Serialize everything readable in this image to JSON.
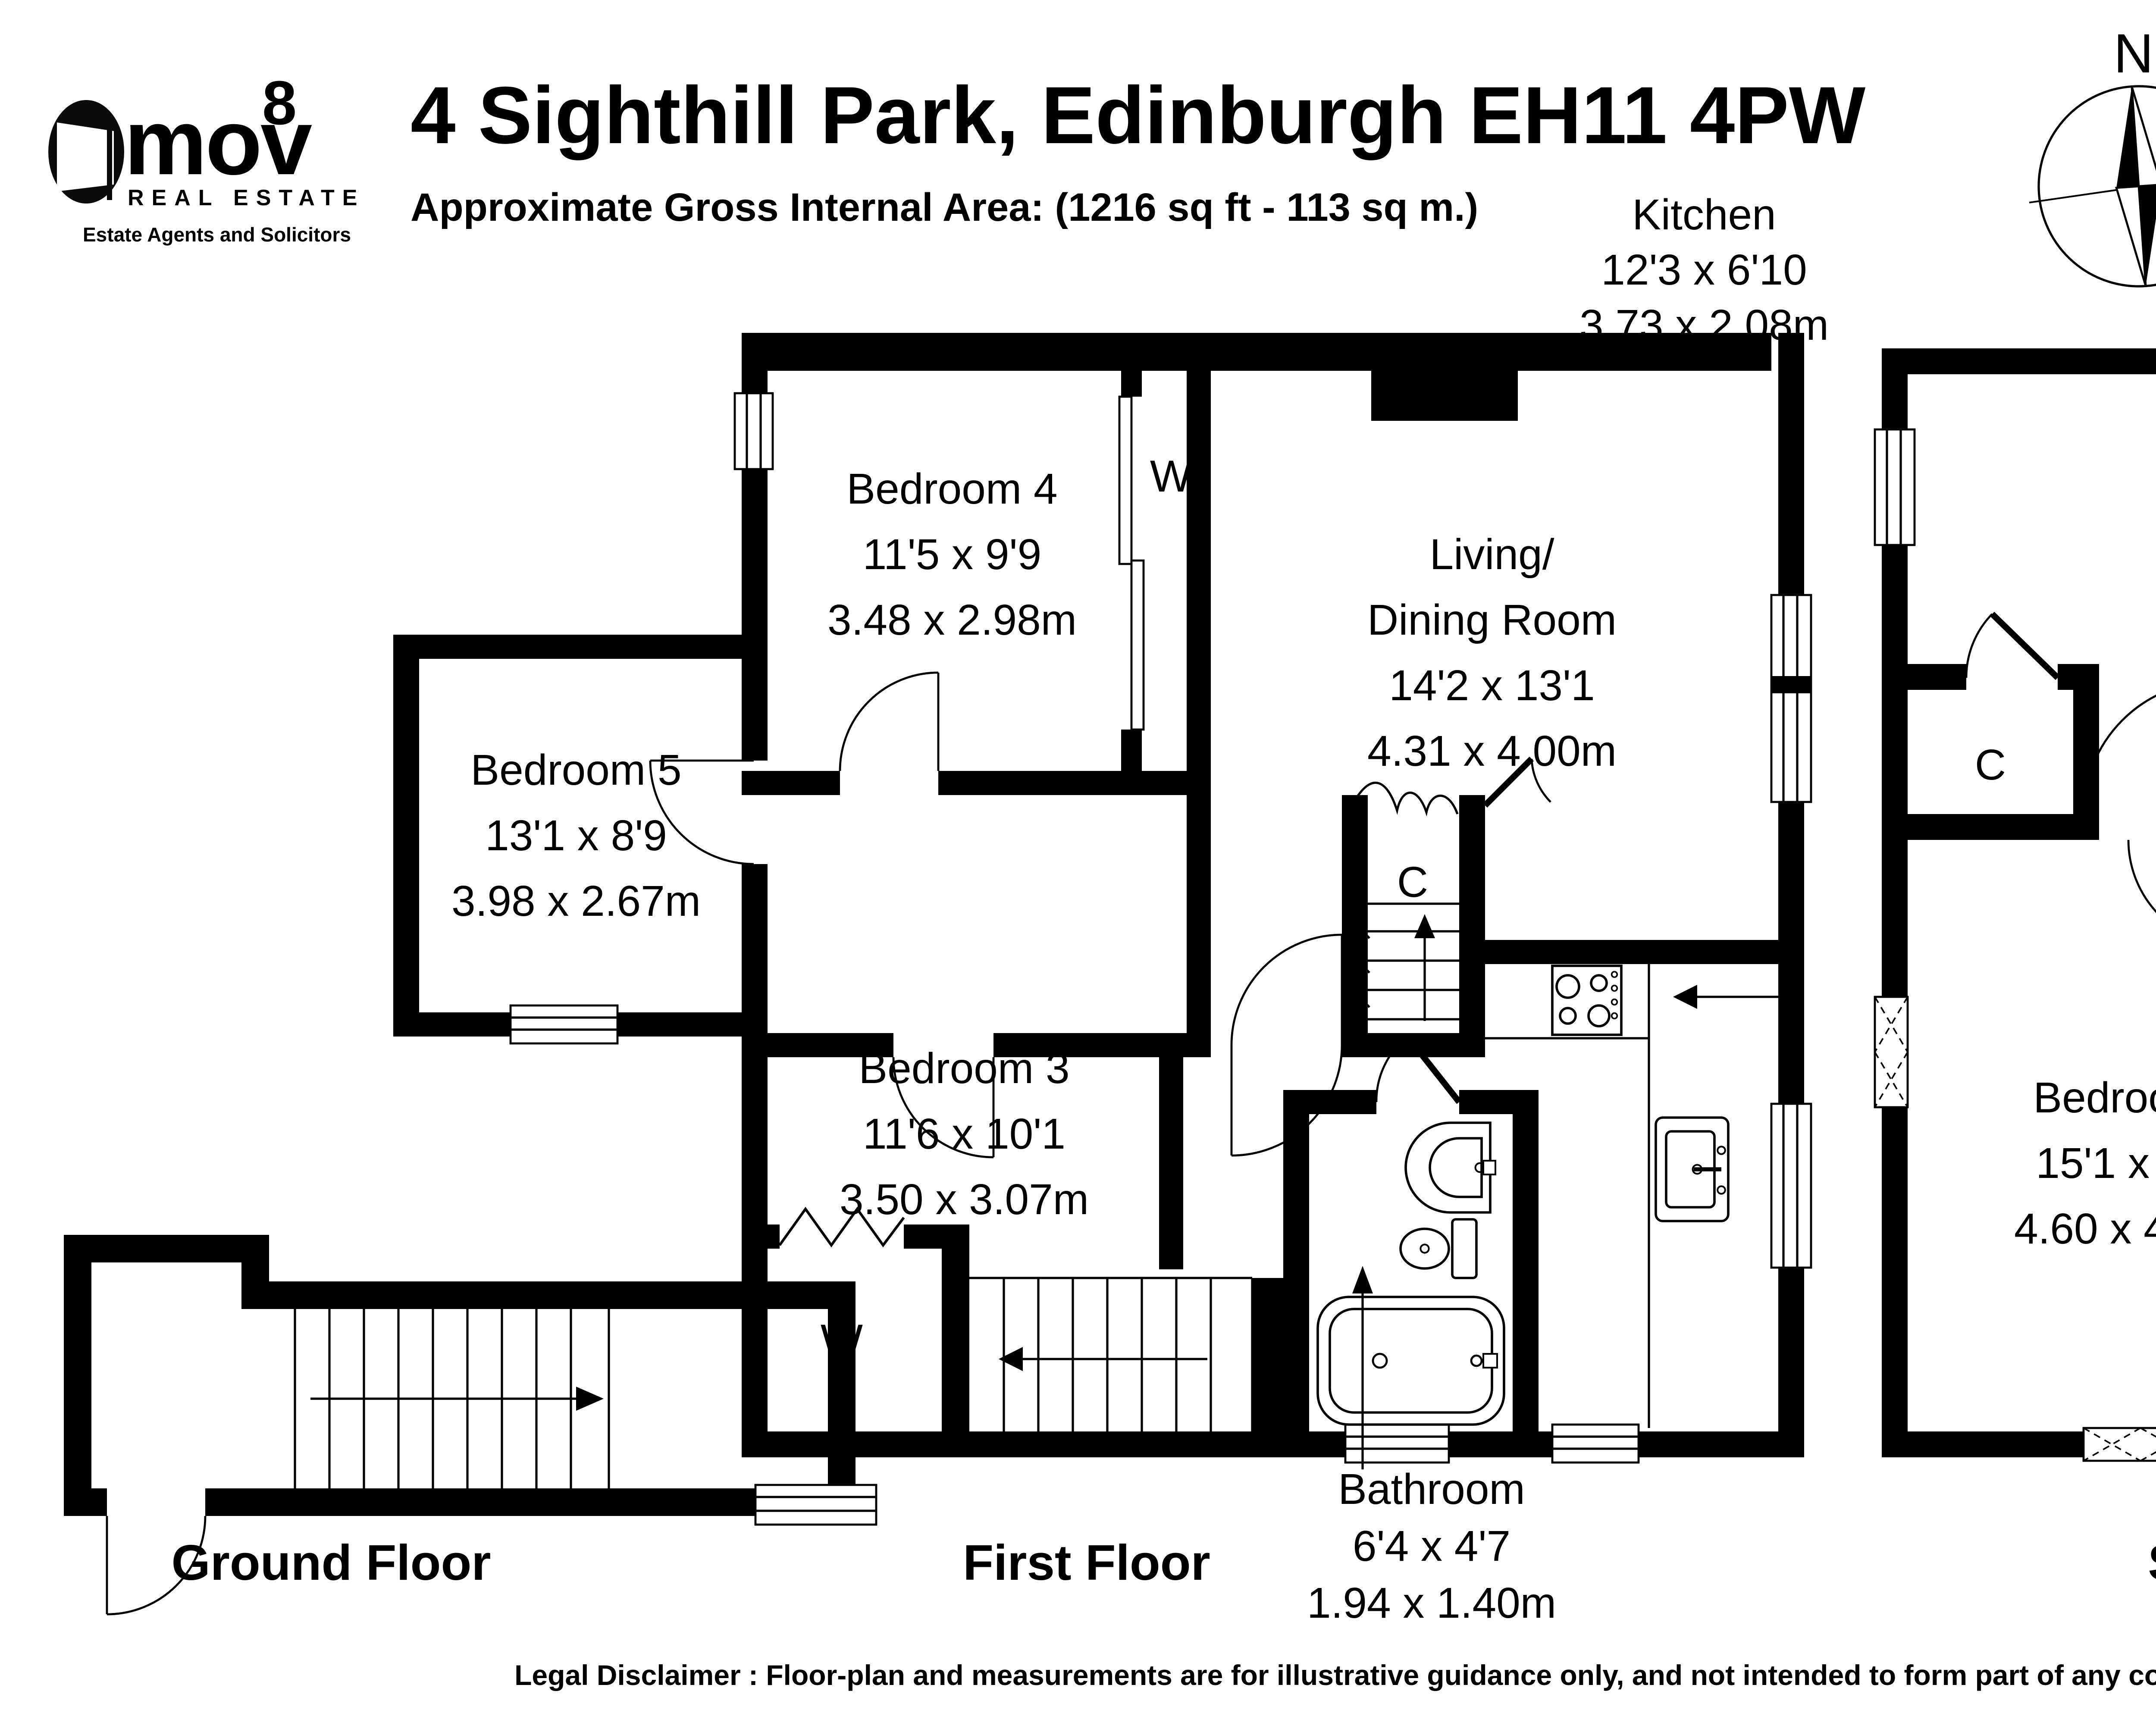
{
  "header": {
    "logo": {
      "brand": "mov",
      "superscript": "8",
      "tagline": "REAL ESTATE",
      "subtagline": "Estate Agents and Solicitors"
    },
    "title": "4 Sighthill Park, Edinburgh EH11 4PW",
    "subtitle": "Approximate Gross Internal Area: (1216 sq ft - 113 sq m.)"
  },
  "compass": {
    "north_label": "N"
  },
  "rooms": {
    "kitchen": {
      "name": "Kitchen",
      "imperial": "12'3 x 6'10",
      "metric": "3.73 x 2.08m"
    },
    "living_dining": {
      "name_line1": "Living/",
      "name_line2": "Dining Room",
      "imperial": "14'2 x 13'1",
      "metric": "4.31 x 4.00m"
    },
    "bedroom1": {
      "name": "Bedroom 1",
      "imperial": "19'9 x 7'10",
      "metric": "6.03 x 2.38m"
    },
    "bedroom2": {
      "name": "Bedroom 2",
      "imperial": "15'1 x 13'4",
      "metric": "4.60 x 4.06m"
    },
    "bedroom3": {
      "name": "Bedroom 3",
      "imperial": "11'6 x 10'1",
      "metric": "3.50 x 3.07m"
    },
    "bedroom4": {
      "name": "Bedroom 4",
      "imperial": "11'5 x 9'9",
      "metric": "3.48 x 2.98m"
    },
    "bedroom5": {
      "name": "Bedroom 5",
      "imperial": "13'1 x 8'9",
      "metric": "3.98 x 2.67m"
    },
    "bathroom": {
      "name": "Bathroom",
      "imperial": "6'4 x 4'7",
      "metric": "1.94 x 1.40m"
    },
    "eaves": {
      "name": "Eaves"
    }
  },
  "closet_labels": {
    "w_bedroom4": "W",
    "w_bedroom3": "W",
    "c_first": "C",
    "c_second_left": "C",
    "c_second_right": "C"
  },
  "floor_labels": {
    "ground": "Ground Floor",
    "first": "First Floor",
    "second": "Second Floor"
  },
  "disclaimer": {
    "text": "Legal Disclaimer : Floor-plan and measurements are for illustrative guidance only, and not intended to form part of any contract."
  },
  "colors": {
    "ink": "#000000",
    "background": "#ffffff"
  }
}
